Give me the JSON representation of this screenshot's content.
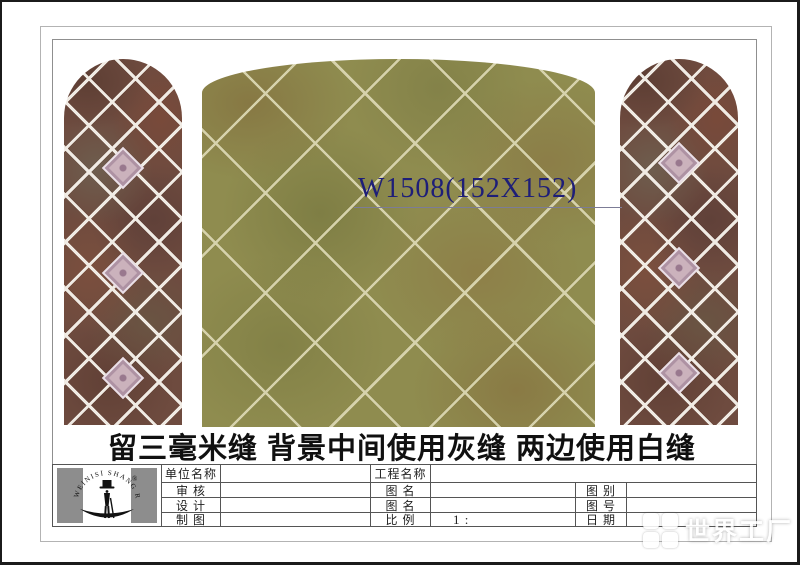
{
  "annotation": {
    "label": "W1508(152X152)"
  },
  "caption": "留三毫米缝 背景中间使用灰缝 两边使用白缝",
  "title_block": {
    "logo": {
      "brand_text": "WEINISI SHANG REN",
      "registered_mark": "®"
    },
    "rows": [
      {
        "c1": "单位名称",
        "v1": "",
        "c2": "工程名称",
        "v2": "",
        "c3": "",
        "v3": ""
      },
      {
        "c1": "审 核",
        "v1": "",
        "c2": "图 名",
        "v2": "",
        "c3": "图 别",
        "v3": ""
      },
      {
        "c1": "设 计",
        "v1": "",
        "c2": "图 名",
        "v2": "",
        "c3": "图 号",
        "v3": ""
      },
      {
        "c1": "制 图",
        "v1": "",
        "c2": "比 例",
        "v2": "1 :",
        "c3": "日 期",
        "v3": ""
      }
    ]
  },
  "watermark": {
    "text": "世界工厂"
  },
  "colors": {
    "center_tile": "#8f8c4f",
    "center_grout": "#d6d2ac",
    "side_tile": "#6e4b3f",
    "side_grout": "#f0ebe4",
    "accent_tile": "#cbb2bc",
    "annotation_text": "#1e1e78",
    "caption_text": "#101010"
  }
}
